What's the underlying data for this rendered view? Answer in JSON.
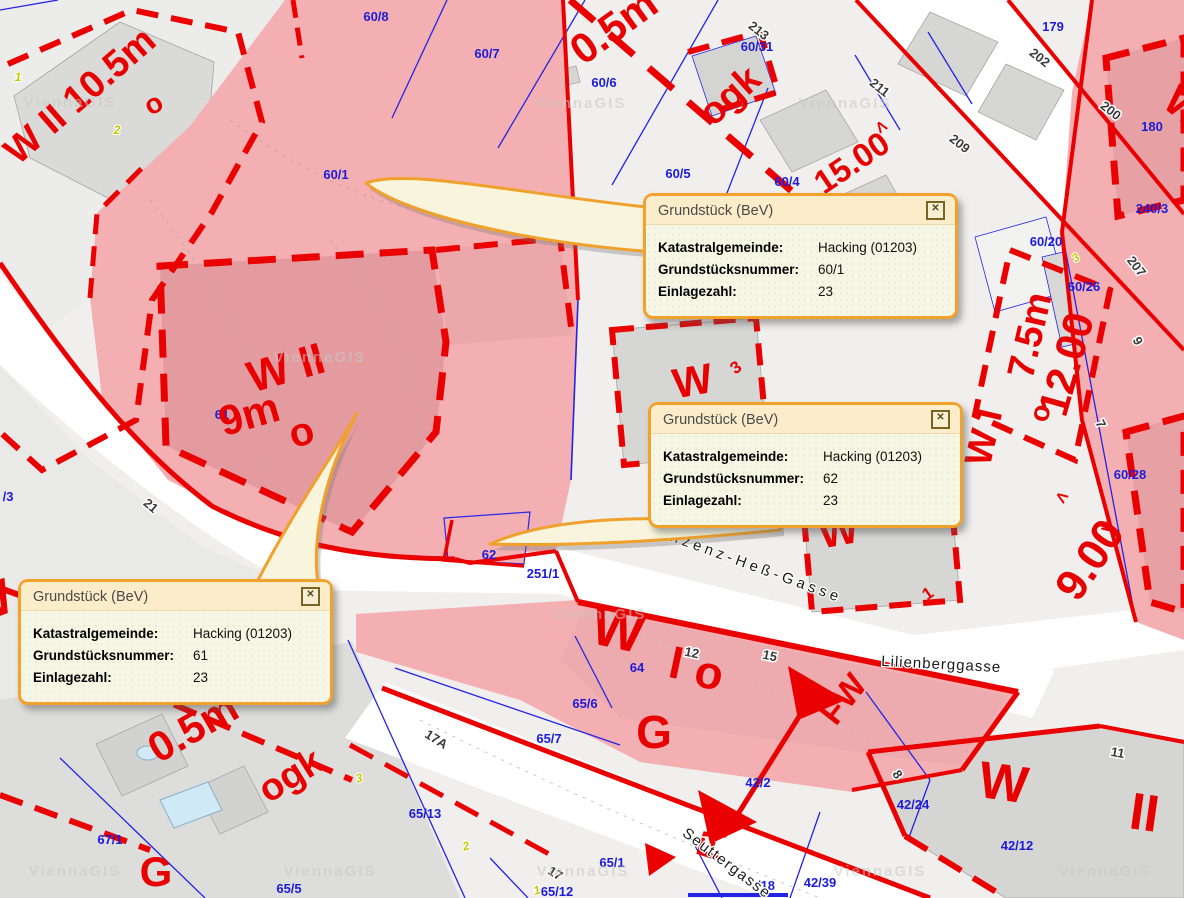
{
  "app": {
    "watermark": "ViennaGIS"
  },
  "colors": {
    "cadastral_red": "#ea0000",
    "parcel_blue": "#2424e4",
    "highlight_pink": "#f4afb2",
    "highlight_pink_dark": "#e49ba0",
    "popup_border": "#f2a22b",
    "popup_header": "#fcedca",
    "popup_bg": "#f5f6e3"
  },
  "popups": [
    {
      "id": "60/1",
      "title": "Grundstück (BeV)",
      "close_glyph": "✕",
      "rows": [
        {
          "label": "Katastralgemeinde:",
          "value": "Hacking (01203)"
        },
        {
          "label": "Grundstücksnummer:",
          "value": "60/1"
        },
        {
          "label": "Einlagezahl:",
          "value": "23"
        }
      ]
    },
    {
      "id": "62",
      "title": "Grundstück (BeV)",
      "close_glyph": "✕",
      "rows": [
        {
          "label": "Katastralgemeinde:",
          "value": "Hacking (01203)"
        },
        {
          "label": "Grundstücksnummer:",
          "value": "62"
        },
        {
          "label": "Einlagezahl:",
          "value": "23"
        }
      ]
    },
    {
      "id": "61",
      "title": "Grundstück (BeV)",
      "close_glyph": "✕",
      "rows": [
        {
          "label": "Katastralgemeinde:",
          "value": "Hacking (01203)"
        },
        {
          "label": "Grundstücksnummer:",
          "value": "61"
        },
        {
          "label": "Einlagezahl:",
          "value": "23"
        }
      ]
    }
  ],
  "map": {
    "labels": [
      {
        "t": "60/8",
        "x": 376,
        "y": 21,
        "c": "blue"
      },
      {
        "t": "60/7",
        "x": 487,
        "y": 58,
        "c": "blue"
      },
      {
        "t": "60/6",
        "x": 604,
        "y": 87,
        "c": "blue"
      },
      {
        "t": "60/5",
        "x": 678,
        "y": 178,
        "c": "blue"
      },
      {
        "t": "60/4",
        "x": 787,
        "y": 186,
        "c": "blue",
        "s": 12
      },
      {
        "t": "60/31",
        "x": 757,
        "y": 51,
        "c": "blue",
        "s": 12
      },
      {
        "t": "179",
        "x": 1053,
        "y": 31,
        "c": "blue"
      },
      {
        "t": "180",
        "x": 1152,
        "y": 131,
        "c": "blue"
      },
      {
        "t": "240/3",
        "x": 1152,
        "y": 213,
        "c": "blue"
      },
      {
        "t": "60/20",
        "x": 1046,
        "y": 246,
        "c": "blue"
      },
      {
        "t": "60/26",
        "x": 1084,
        "y": 291,
        "c": "blue",
        "s": 12
      },
      {
        "t": "60/28",
        "x": 1130,
        "y": 479,
        "c": "blue"
      },
      {
        "t": "60/1",
        "x": 336,
        "y": 179,
        "c": "blue",
        "s": 12
      },
      {
        "t": "61",
        "x": 222,
        "y": 419,
        "c": "blue",
        "s": 12
      },
      {
        "t": "62",
        "x": 489,
        "y": 559,
        "c": "blue",
        "s": 12
      },
      {
        "t": "251/1",
        "x": 543,
        "y": 578,
        "c": "blue"
      },
      {
        "t": "64",
        "x": 637,
        "y": 672,
        "c": "blue",
        "s": 12
      },
      {
        "t": "65/6",
        "x": 585,
        "y": 708,
        "c": "blue"
      },
      {
        "t": "65/7",
        "x": 549,
        "y": 743,
        "c": "blue"
      },
      {
        "t": "65/13",
        "x": 425,
        "y": 818,
        "c": "blue"
      },
      {
        "t": "65/1",
        "x": 612,
        "y": 867,
        "c": "blue"
      },
      {
        "t": "65/12",
        "x": 557,
        "y": 896,
        "c": "blue"
      },
      {
        "t": "67/1",
        "x": 110,
        "y": 844,
        "c": "blue"
      },
      {
        "t": "65/5",
        "x": 289,
        "y": 893,
        "c": "blue"
      },
      {
        "t": "42/2",
        "x": 758,
        "y": 787,
        "c": "blue",
        "s": 12
      },
      {
        "t": "42/24",
        "x": 913,
        "y": 809,
        "c": "blue"
      },
      {
        "t": "42/12",
        "x": 1017,
        "y": 850,
        "c": "blue"
      },
      {
        "t": "42/39",
        "x": 820,
        "y": 887,
        "c": "blue",
        "s": 12
      },
      {
        "t": "/18",
        "x": 766,
        "y": 890,
        "c": "blue",
        "s": 12
      },
      {
        "t": "/3",
        "x": 8,
        "y": 501,
        "c": "blue",
        "s": 12
      },
      {
        "t": "213",
        "x": 756,
        "y": 34,
        "r": 38,
        "c": "addr"
      },
      {
        "t": "211",
        "x": 877,
        "y": 91,
        "r": 38,
        "c": "addr"
      },
      {
        "t": "209",
        "x": 957,
        "y": 147,
        "r": 38,
        "c": "addr"
      },
      {
        "t": "202",
        "x": 1037,
        "y": 61,
        "r": 38,
        "c": "addr"
      },
      {
        "t": "200",
        "x": 1108,
        "y": 114,
        "r": 38,
        "c": "addr"
      },
      {
        "t": "207",
        "x": 1133,
        "y": 269,
        "r": 52,
        "c": "addr"
      },
      {
        "t": "9",
        "x": 1134,
        "y": 343,
        "r": 62,
        "c": "addr"
      },
      {
        "t": "7",
        "x": 1097,
        "y": 426,
        "r": 62,
        "c": "addr"
      },
      {
        "t": "21",
        "x": 148,
        "y": 509,
        "r": 40,
        "c": "addr"
      },
      {
        "t": "17A",
        "x": 434,
        "y": 743,
        "r": 32,
        "c": "addr"
      },
      {
        "t": "17",
        "x": 553,
        "y": 877,
        "r": 32,
        "c": "addr"
      },
      {
        "t": "12",
        "x": 691,
        "y": 657,
        "r": 12,
        "c": "addr"
      },
      {
        "t": "15",
        "x": 769,
        "y": 660,
        "r": 12,
        "c": "addr"
      },
      {
        "t": "11",
        "x": 1117,
        "y": 757,
        "r": 10,
        "c": "addr"
      },
      {
        "t": "8",
        "x": 894,
        "y": 777,
        "r": 55,
        "c": "addr"
      },
      {
        "t": "W II 10.5m",
        "x": 88,
        "y": 105,
        "r": -41,
        "c": "zone",
        "s": 38
      },
      {
        "t": "o",
        "x": 158,
        "y": 112,
        "r": -30,
        "c": "zone",
        "s": 28
      },
      {
        "t": "0.5m",
        "x": 622,
        "y": 38,
        "r": -36,
        "c": "zone",
        "s": 42
      },
      {
        "t": "ogk",
        "x": 738,
        "y": 105,
        "r": -42,
        "c": "zone",
        "s": 38
      },
      {
        "t": "15.00",
        "x": 858,
        "y": 172,
        "r": -34,
        "c": "zone",
        "s": 33
      },
      {
        "t": "Λ",
        "x": 884,
        "y": 131,
        "r": -34,
        "c": "zone",
        "s": 15
      },
      {
        "t": "W II",
        "x": 290,
        "y": 382,
        "r": -16,
        "c": "zone",
        "s": 44
      },
      {
        "t": "9m",
        "x": 253,
        "y": 428,
        "r": -16,
        "c": "zone",
        "s": 42
      },
      {
        "t": "o",
        "x": 305,
        "y": 445,
        "r": -16,
        "c": "zone",
        "s": 40
      },
      {
        "t": "W",
        "x": 695,
        "y": 395,
        "r": -10,
        "c": "zone",
        "s": 42
      },
      {
        "t": "3",
        "x": 739,
        "y": 372,
        "r": -35,
        "c": "zone",
        "s": 17
      },
      {
        "t": "W",
        "x": 841,
        "y": 545,
        "r": -10,
        "c": "zone",
        "s": 42
      },
      {
        "t": "1",
        "x": 931,
        "y": 598,
        "r": -35,
        "c": "zone",
        "s": 17
      },
      {
        "t": "W I",
        "x": 996,
        "y": 440,
        "r": -77,
        "c": "zone",
        "s": 38
      },
      {
        "t": "7.5m",
        "x": 1042,
        "y": 338,
        "r": -77,
        "c": "zone",
        "s": 38
      },
      {
        "t": "o",
        "x": 1049,
        "y": 415,
        "r": -77,
        "c": "zone",
        "s": 28
      },
      {
        "t": "12.00",
        "x": 1080,
        "y": 368,
        "r": -74,
        "c": "zone",
        "s": 42
      },
      {
        "t": "9.00",
        "x": 1102,
        "y": 568,
        "r": -56,
        "c": "zone",
        "s": 44
      },
      {
        "t": "Λ",
        "x": 1066,
        "y": 500,
        "r": -56,
        "c": "zone",
        "s": 15
      },
      {
        "t": "V",
        "x": 1112,
        "y": 531,
        "r": -56,
        "c": "zone",
        "s": 15
      },
      {
        "t": "W",
        "x": 614,
        "y": 648,
        "r": 12,
        "c": "zone",
        "s": 54
      },
      {
        "t": "I",
        "x": 673,
        "y": 678,
        "r": 12,
        "c": "zone",
        "s": 46
      },
      {
        "t": "o",
        "x": 706,
        "y": 688,
        "r": 12,
        "c": "zone",
        "s": 46
      },
      {
        "t": "G",
        "x": 654,
        "y": 748,
        "c": "zone",
        "s": 46
      },
      {
        "t": "G",
        "x": 156,
        "y": 886,
        "c": "zone",
        "s": 42
      },
      {
        "t": "ogk",
        "x": 297,
        "y": 786,
        "r": -32,
        "c": "zone",
        "s": 38
      },
      {
        "t": "0.5m",
        "x": 200,
        "y": 740,
        "r": -30,
        "c": "zone",
        "s": 42
      },
      {
        "t": "W",
        "x": 1001,
        "y": 800,
        "r": 8,
        "c": "zone",
        "s": 52
      },
      {
        "t": "II",
        "x": 1142,
        "y": 830,
        "r": 8,
        "c": "zone",
        "s": 52
      },
      {
        "t": "FW",
        "x": 852,
        "y": 706,
        "r": -52,
        "c": "zone",
        "s": 34
      },
      {
        "t": "FW",
        "x": 726,
        "y": 838,
        "r": -72,
        "c": "zone",
        "s": 34
      },
      {
        "t": "W",
        "x": 1176,
        "y": 118,
        "r": 40,
        "c": "zone",
        "s": 42
      },
      {
        "t": "W",
        "x": -6,
        "y": 618,
        "r": -20,
        "c": "zone",
        "s": 50
      },
      {
        "t": "1",
        "x": 18,
        "y": 81,
        "c": "yel"
      },
      {
        "t": "2",
        "x": 117,
        "y": 134,
        "c": "yel"
      },
      {
        "t": "2",
        "x": 467,
        "y": 850,
        "r": -15,
        "c": "yel"
      },
      {
        "t": "1",
        "x": 538,
        "y": 894,
        "r": -15,
        "c": "yel"
      },
      {
        "t": "3",
        "x": 360,
        "y": 782,
        "r": -15,
        "c": "yel"
      },
      {
        "t": "3",
        "x": 1078,
        "y": 261,
        "r": -35,
        "c": "yel"
      },
      {
        "t": "Vinzenz-Heß-Gasse",
        "x": 745,
        "y": 568,
        "r": 20,
        "c": "street",
        "s": 16,
        "ls": 4
      },
      {
        "t": "Lilienberggasse",
        "x": 941,
        "y": 669,
        "r": 3,
        "c": "street",
        "s": 13,
        "ls": 1
      },
      {
        "t": "Seuttergasse",
        "x": 724,
        "y": 867,
        "r": 37,
        "c": "street",
        "s": 13,
        "ls": 1.5
      },
      {
        "t": "ViennaGIS",
        "x": 70,
        "y": 107,
        "c": "wm"
      },
      {
        "t": "ViennaGIS",
        "x": 580,
        "y": 108,
        "c": "wm"
      },
      {
        "t": "ViennaGIS",
        "x": 845,
        "y": 108,
        "c": "wm"
      },
      {
        "t": "ViennaGIS",
        "x": 320,
        "y": 362,
        "c": "wm"
      },
      {
        "t": "ViennaGIS",
        "x": 600,
        "y": 619,
        "c": "wm"
      },
      {
        "t": "ViennaGIS",
        "x": 75,
        "y": 876,
        "c": "wm"
      },
      {
        "t": "ViennaGIS",
        "x": 330,
        "y": 876,
        "c": "wm"
      },
      {
        "t": "ViennaGIS",
        "x": 583,
        "y": 876,
        "c": "wm"
      },
      {
        "t": "ViennaGIS",
        "x": 880,
        "y": 876,
        "c": "wm"
      },
      {
        "t": "ViennaGIS",
        "x": 1105,
        "y": 876,
        "c": "wm"
      }
    ]
  }
}
